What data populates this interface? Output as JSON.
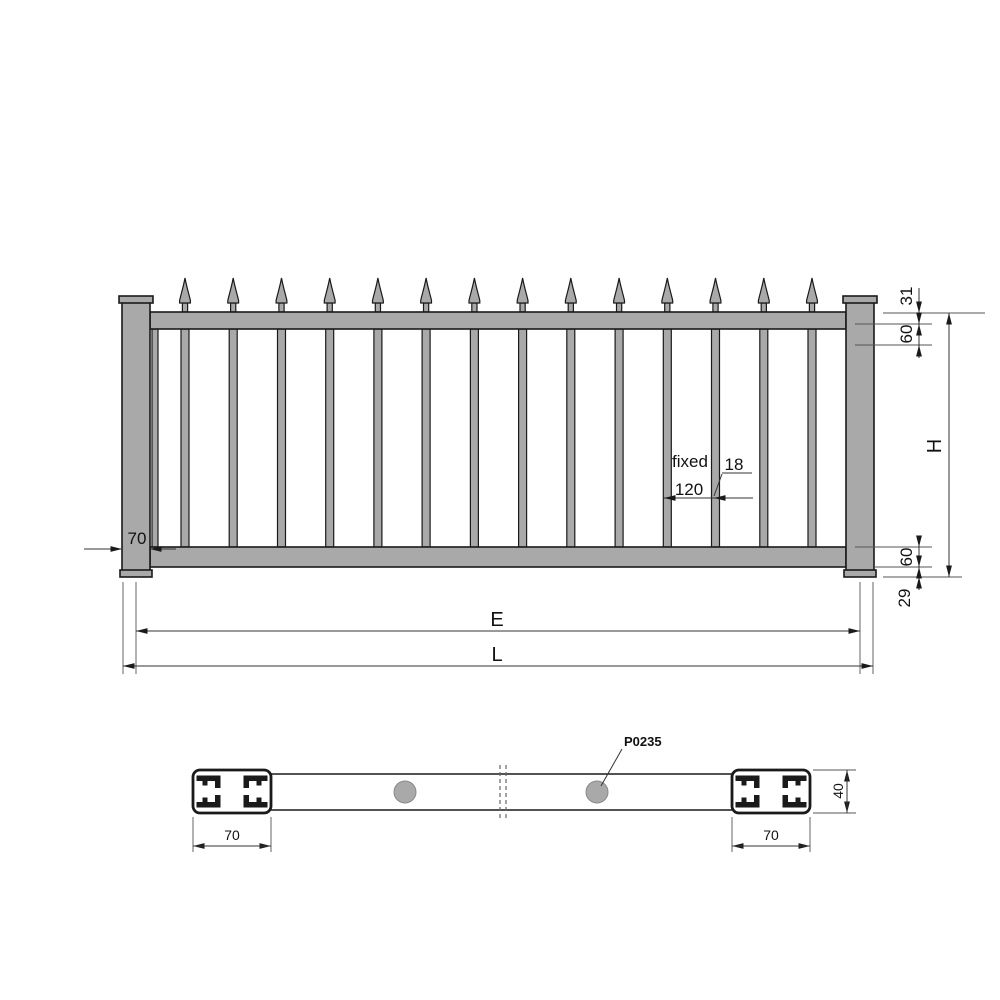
{
  "drawing": {
    "elevation": {
      "picket_count": 14,
      "dim_post_width": "70",
      "dim_finial_offset": "31",
      "dim_top_rail_height": "60",
      "dim_height": "H",
      "dim_bottom_rail_height": "60",
      "dim_bottom_offset": "29",
      "spacing_label": "fixed",
      "dim_picket_spacing": "120",
      "dim_picket_width": "18",
      "dim_span_e": "E",
      "dim_length_l": "L"
    },
    "section": {
      "part_label": "P0235",
      "dim_profile_width_left": "70",
      "dim_profile_width_right": "70",
      "dim_rail_depth": "40"
    },
    "colors": {
      "metal_fill": "#a9a9a9",
      "outline": "#1a1a1a",
      "dimension_line": "#333333"
    }
  }
}
